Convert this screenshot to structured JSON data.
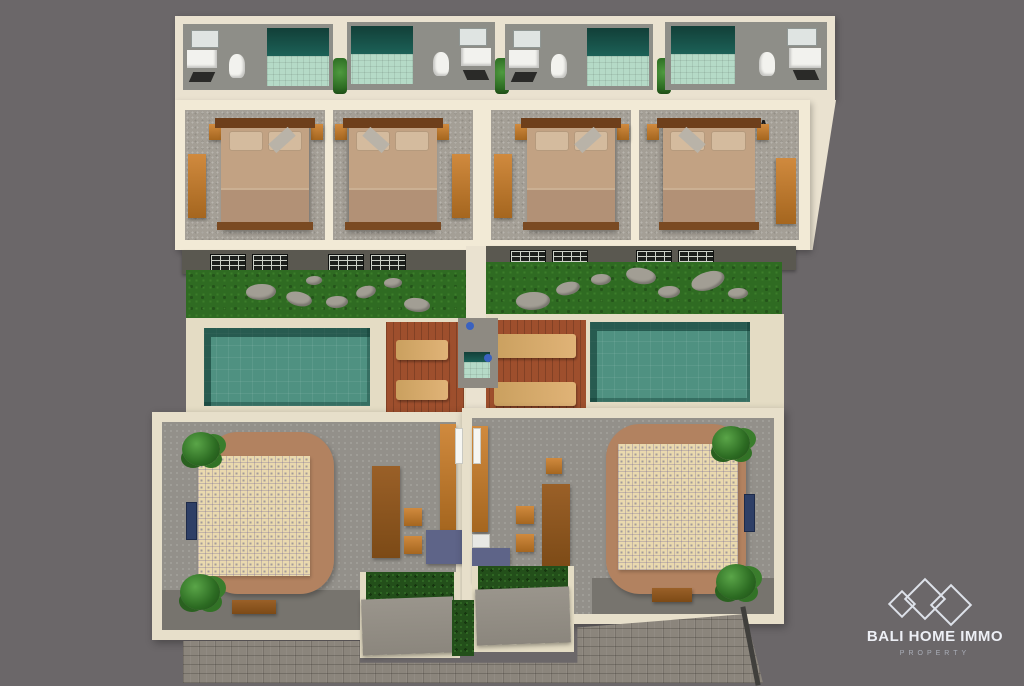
{
  "logo": {
    "brand": "BALI HOME IMMO",
    "tagline": "PROPERTY"
  },
  "scene": {
    "type": "3D aerial cutaway render of a twin-villa property",
    "units": [
      {
        "name": "villa-left",
        "rooms": [
          "bathroom-1",
          "bathroom-2",
          "bedroom-1",
          "bedroom-2",
          "garden",
          "swimming-pool",
          "sun-deck",
          "outdoor-shower",
          "living-room",
          "kitchen",
          "entrance-courtyard"
        ]
      },
      {
        "name": "villa-right",
        "rooms": [
          "bathroom-3",
          "bathroom-4",
          "bedroom-3",
          "bedroom-4",
          "garden",
          "sun-deck",
          "swimming-pool",
          "outdoor-shower",
          "living-room",
          "kitchen",
          "entrance-courtyard"
        ]
      }
    ],
    "exterior": [
      "facade-windows",
      "stepping-stones",
      "hedges-with-flowers",
      "entrance-gates",
      "cobblestone-driveway"
    ]
  },
  "palette": {
    "background": "#6b6769",
    "wall_cream": "#eae2d0",
    "floor_gray": "#93908a",
    "pool_water": "#4f9181",
    "pool_edge": "#17544a",
    "grass": "#2f6b22",
    "deck_terracotta": "#9e4f2d",
    "lounger_tan": "#d8a968",
    "hedge_green": "#234f1a",
    "furniture_wood": "#c07a2e",
    "shower_tile_dark": "#1c6157",
    "shower_tile_mint": "#b5dac7",
    "cabinet_blue": "#5e6488",
    "facade_gray": "#5a5850",
    "logo_text": "#edeff5"
  }
}
